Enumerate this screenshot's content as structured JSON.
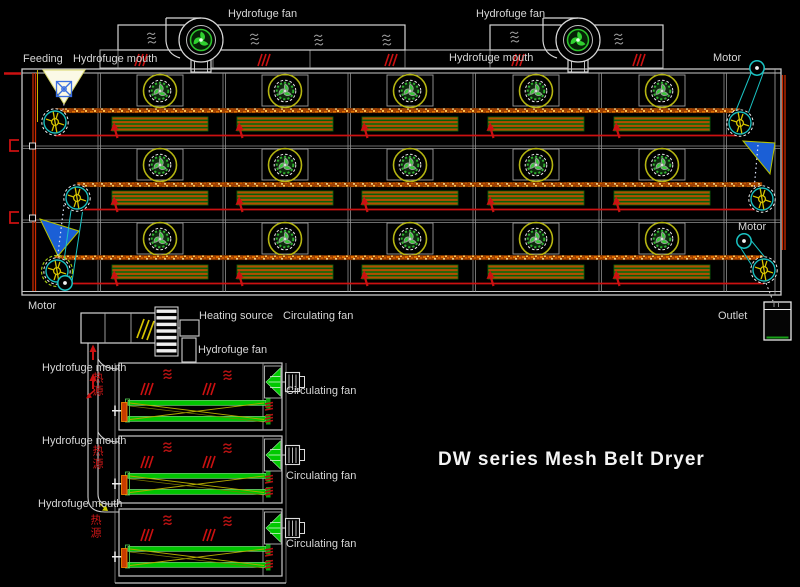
{
  "title": "DW series Mesh Belt Dryer",
  "top_view": {
    "feeding": "Feeding",
    "hydrofuge_fan": [
      "Hydrofuge fan",
      "Hydrofuge fan"
    ],
    "hydrofuge_mouth": [
      "Hydrofuge mouth",
      "Hydrofuge mouth"
    ],
    "motor": [
      "Motor",
      "Motor",
      "Motor"
    ],
    "outlet": "Outlet"
  },
  "side_view": {
    "heating_source": "Heating source",
    "circulating_fan_header": "Circulating fan",
    "hydrofuge_fan": "Hydrofuge fan",
    "hydrofuge_mouth": [
      "Hydrofuge mouth",
      "Hydrofuge mouth",
      "Hydrofuge mouth"
    ],
    "heat_source_cn": [
      "热源",
      "热源",
      "热源"
    ],
    "circulating_fan": [
      "Circulating fan",
      "Circulating fan",
      "Circulating fan"
    ]
  },
  "icons": {
    "hydrofuge_fan_icon": "scroll-blower with 3-blade green impeller",
    "body_fan_icon": "axial fan in yellow ring",
    "pulley_icon": "cyan belt pulley with yellow sprocket",
    "motor_icon": "small cyan circle with white hub",
    "chute_icon": "blue transfer chute triangle",
    "hopper_icon": "white feed hopper with blue emblem",
    "heater_icon": "orange finned heater bars",
    "cone_fan_icon": "green cone circulating fan with motor"
  },
  "colors": {
    "background": "#000000",
    "outline": "#d8d8d8",
    "grid": "#909090",
    "red": "#cc1111",
    "dark_red": "#b51212",
    "belt_orange": "#b34d00",
    "belt_speckle": "#e07000",
    "heater_edge_green": "#0b6b0b",
    "fan_green": "#2fd12f",
    "ring_yellow": "#b5b511",
    "sprocket_yellow": "#d6c400",
    "cyan": "#19bdbd",
    "chute_blue": "#1b5fd6",
    "green_belt": "#00c400",
    "cone_green": "#00c800",
    "white": "#f2f2f2"
  }
}
